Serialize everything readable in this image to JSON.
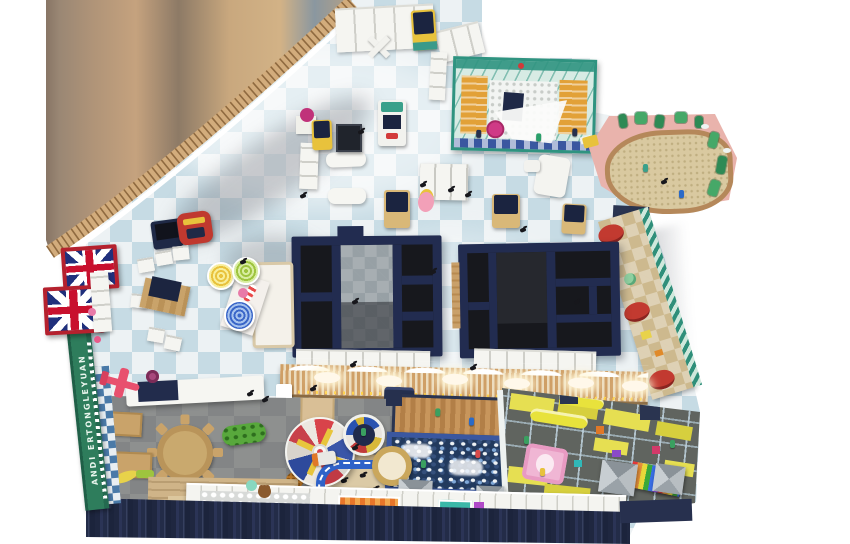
{
  "scene": {
    "description": "Top-down 3D rendering of an indoor children's playground floor plan on white background",
    "background": "#ffffff"
  },
  "banner": {
    "text": "ANDI ERTONGLEYUAN"
  },
  "palette": {
    "floor_tile_blue": "#c6dbe4",
    "floor_tile_white": "#edf2f4",
    "carpet_gray": "#8e908f",
    "structure_navy": "#222c50",
    "wood": "#c89a62",
    "sand": "#d9c9a0",
    "sand_wall_pink": "#e9b3ac",
    "glass_teal": "#2f9380",
    "banner_green": "#2e7d5c",
    "flag_red": "#b5212e",
    "facade_navy": "#27304e",
    "ballpit_navy": "#223a5e",
    "slide_pink": "#f2b0cc",
    "panel_yellow": "#e6df52",
    "track_blue": "#2f62c8"
  },
  "zones": [
    {
      "name": "reception-checkered-hall"
    },
    {
      "name": "white-ball-pit-room"
    },
    {
      "name": "sand-play-area"
    },
    {
      "name": "party-room-1"
    },
    {
      "name": "party-room-2"
    },
    {
      "name": "toddler-carpet-area"
    },
    {
      "name": "carousel"
    },
    {
      "name": "trampoline"
    },
    {
      "name": "car-track"
    },
    {
      "name": "main-ball-pit"
    },
    {
      "name": "soft-play-structure"
    },
    {
      "name": "entrance-facade"
    }
  ],
  "decor": {
    "flags": {
      "type": "union-jack",
      "count": 2
    },
    "lollipops": [
      "yellow",
      "green",
      "blue"
    ]
  }
}
